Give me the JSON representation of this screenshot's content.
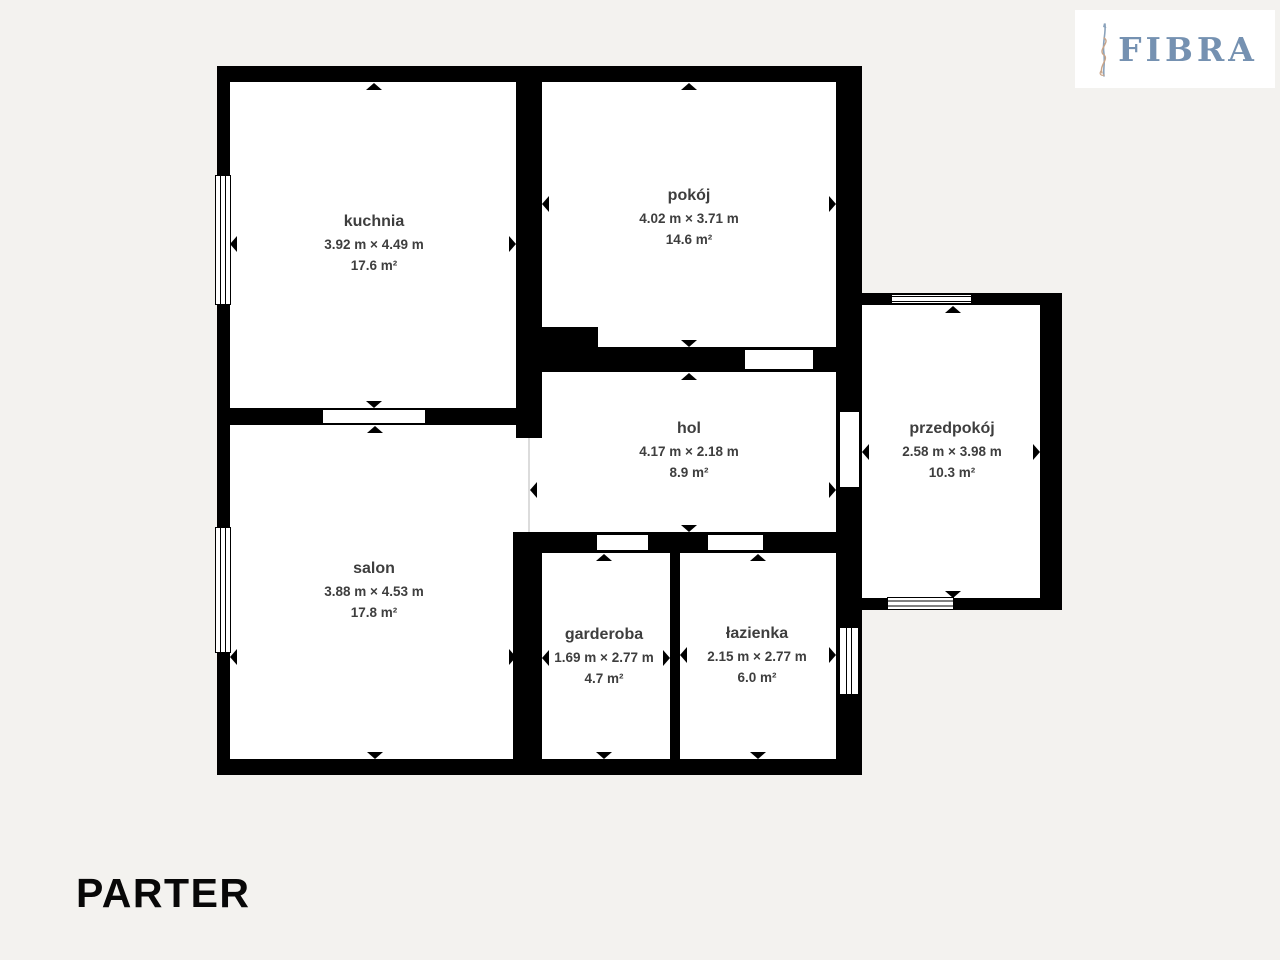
{
  "page": {
    "background_color": "#f3f2ef",
    "floor_label": "PARTER"
  },
  "logo": {
    "brand": "FIBRA",
    "brand_color": "#7591b1",
    "ornament_icon": "fibra-stem-ornament"
  },
  "plan": {
    "wall_color": "#000000",
    "floor_color": "#ffffff",
    "label_color": "#3e3e3e",
    "symbols": {
      "measure_arrow": "black-triangle",
      "window": "double-line-window",
      "door": "wall-opening"
    },
    "rooms": [
      {
        "id": "kuchnia",
        "name": "kuchnia",
        "dimensions": "3.92 m × 4.49 m",
        "area": "17.6 m²"
      },
      {
        "id": "pokoj",
        "name": "pokój",
        "dimensions": "4.02 m × 3.71 m",
        "area": "14.6 m²"
      },
      {
        "id": "hol",
        "name": "hol",
        "dimensions": "4.17 m × 2.18 m",
        "area": "8.9 m²"
      },
      {
        "id": "przedpokoj",
        "name": "przedpokój",
        "dimensions": "2.58 m × 3.98 m",
        "area": "10.3 m²"
      },
      {
        "id": "salon",
        "name": "salon",
        "dimensions": "3.88 m × 4.53 m",
        "area": "17.8 m²"
      },
      {
        "id": "garderoba",
        "name": "garderoba",
        "dimensions": "1.69 m × 2.77 m",
        "area": "4.7 m²"
      },
      {
        "id": "lazienka",
        "name": "łazienka",
        "dimensions": "2.15 m × 2.77 m",
        "area": "6.0 m²"
      }
    ]
  }
}
